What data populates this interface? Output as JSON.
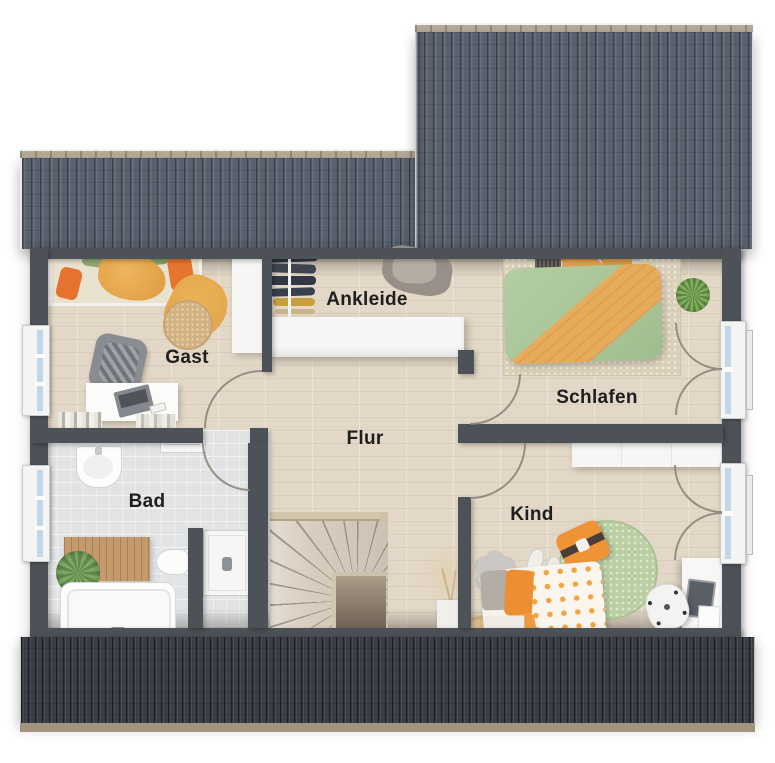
{
  "floorplan": {
    "type": "floor-plan",
    "floor_hint": "upper floor with winder staircase",
    "rooms": [
      {
        "id": "gast",
        "label": "Gast"
      },
      {
        "id": "ankleide",
        "label": "Ankleide"
      },
      {
        "id": "schlafen",
        "label": "Schlafen"
      },
      {
        "id": "flur",
        "label": "Flur"
      },
      {
        "id": "bad",
        "label": "Bad"
      },
      {
        "id": "kind",
        "label": "Kind"
      }
    ],
    "colors": {
      "roof_upper": "#5c6471",
      "roof_lower": "#3a3f47",
      "ridge_cap": "#b6ab99",
      "wall": "#4d5258",
      "wood_floor": "#e3d8c7",
      "tile_floor": "#e1e3e5",
      "accent_orange": "#ec8e36",
      "duvet_green": "#a9c69b",
      "rug_green": "#b9cfa3",
      "rug_jute": "#d3b181",
      "window_glass": "#c3d8e7"
    }
  }
}
